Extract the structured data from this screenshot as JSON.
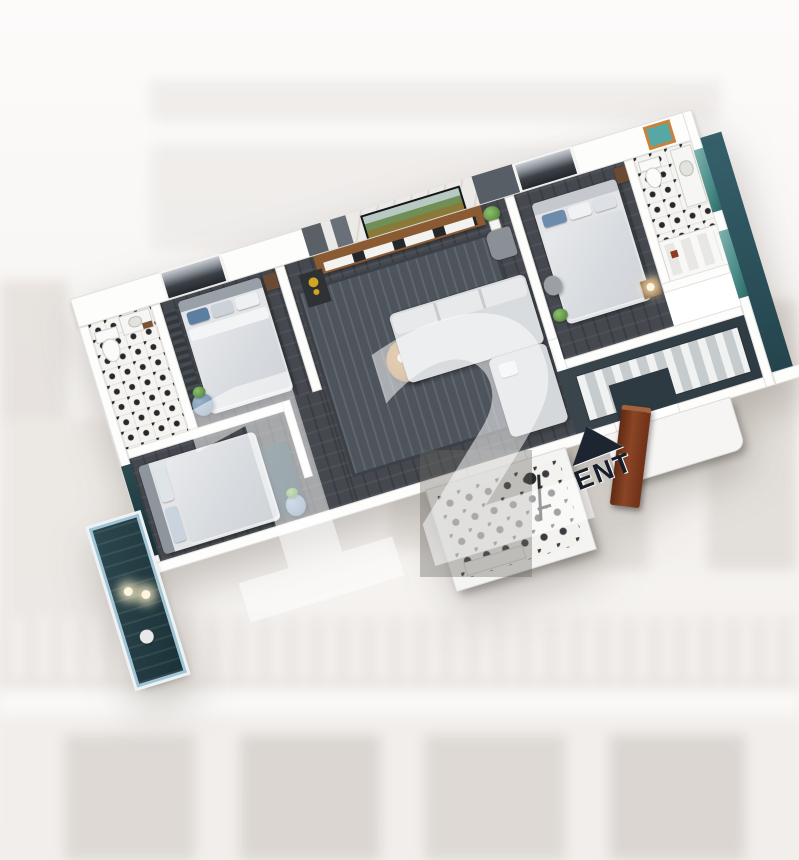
{
  "watermark": {
    "text": "12"
  },
  "entrance": {
    "label": "ENT"
  },
  "palette": {
    "background": "#f6f4f2",
    "wall": "#fdfdfc",
    "carpet_dark": "#45494f",
    "hall_floor": "#36444c",
    "balcony_floor": "#2c474e",
    "balcony_glass": "#a8cfdd",
    "window_glass": "#5fa19c",
    "door_wood": "#7c3a1d",
    "entrance_marker": "#1d2531",
    "watermark_white": "rgba(255,255,255,0.52)",
    "tv_console_wood": "#8a5a33",
    "coffee_table_wood": "#b98a54",
    "gold_figurine": "#d2a522",
    "plant_green": "#6fae57",
    "pouf_blue": "#7d99b5",
    "mirror_frame_orange": "#c8833a"
  }
}
